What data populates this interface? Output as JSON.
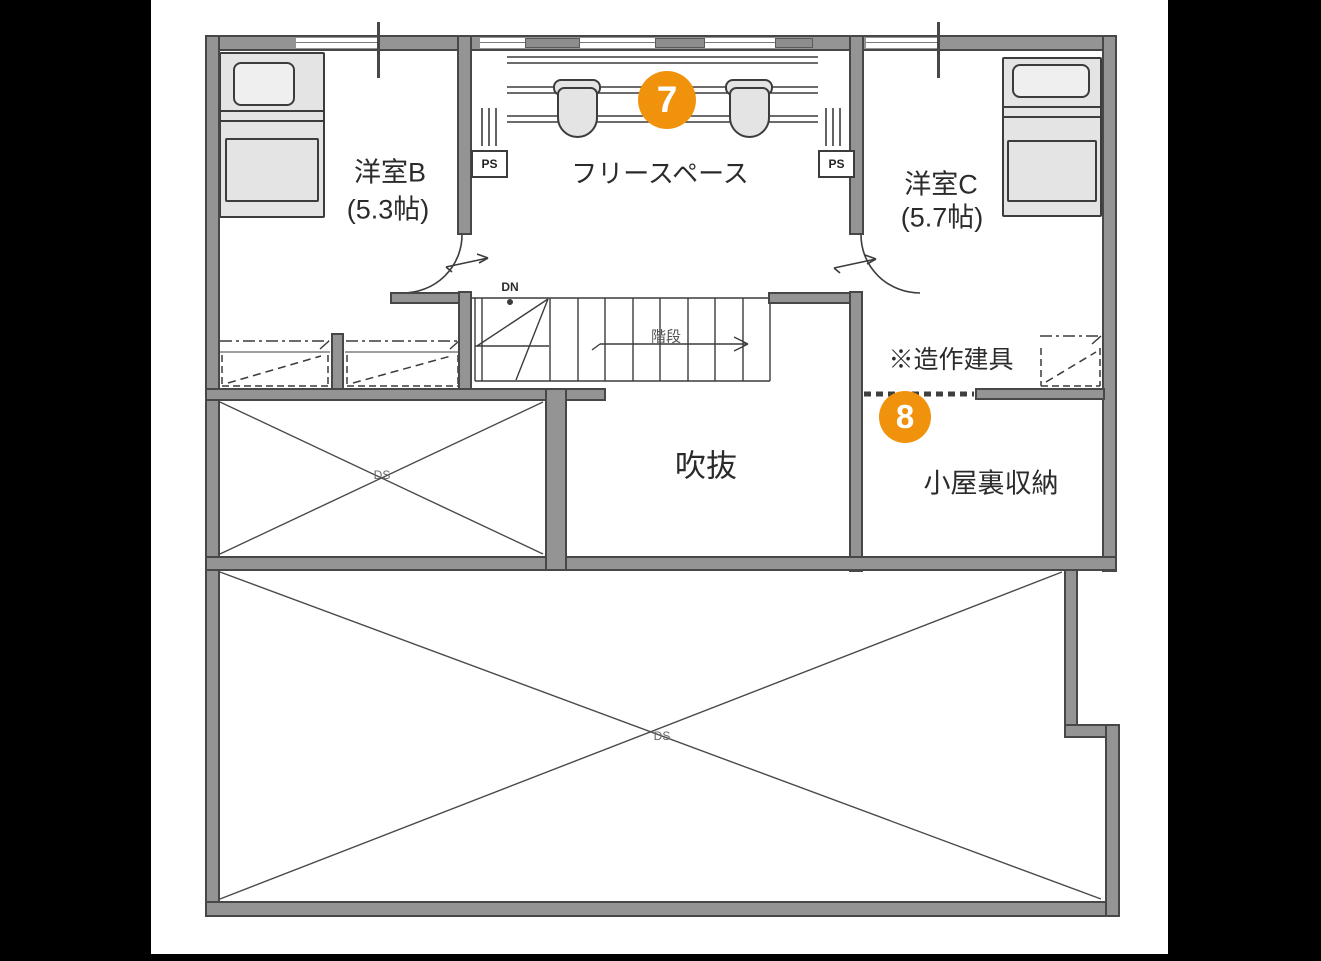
{
  "fp": {
    "rooms": {
      "b": {
        "name": "洋室B",
        "size": "(5.3帖)"
      },
      "free": {
        "name": "フリースペース"
      },
      "c": {
        "name": "洋室C",
        "size": "(5.7帖)"
      },
      "void": {
        "name": "吹抜"
      },
      "attic": {
        "name": "小屋裏収納"
      }
    },
    "labels": {
      "custom_fittings": "※造作建具",
      "stairs": "階段",
      "down": "DN",
      "ps": "PS",
      "ds": "DS"
    },
    "markers": {
      "m7": "7",
      "m8": "8"
    },
    "colors": {
      "wall": "#949494",
      "wall_edge": "#474747",
      "furniture": "#e4e4e4",
      "line": "#3c3c3c",
      "marker_orange": "#f1920d",
      "text": "#2b2b2b",
      "paper": "#ffffff",
      "letterbox": "#000000"
    }
  }
}
